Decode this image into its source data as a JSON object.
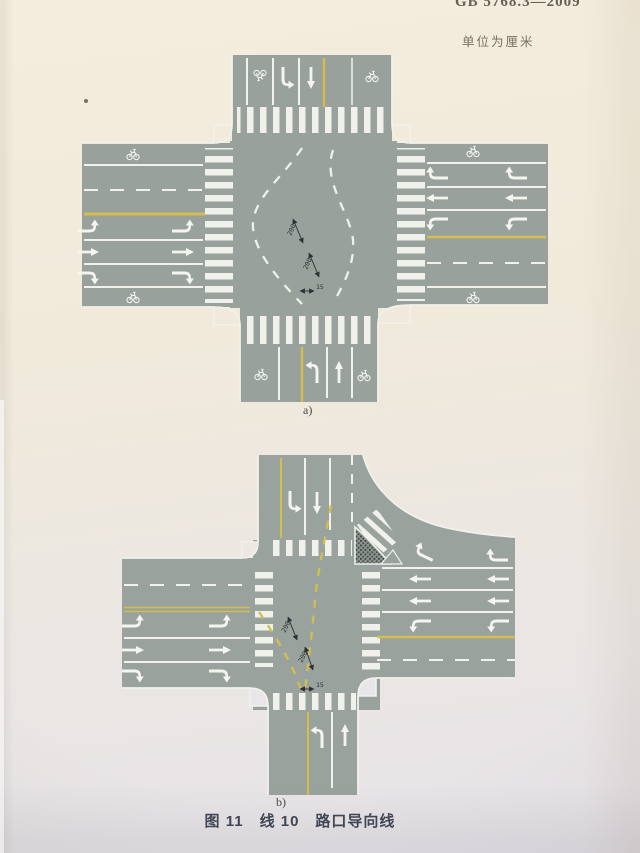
{
  "header": {
    "standard_code": "GB 5768.3—2009",
    "unit_note": "单位为厘米"
  },
  "figure": {
    "caption": "图 11　线 10　路口导向线",
    "label_a": "a)",
    "label_b": "b)"
  },
  "dimensions": {
    "dash_length": "200",
    "gap_length": "200",
    "line_width": "15"
  },
  "colors": {
    "road": "#98a19b",
    "lane-line": "#f1f2ec",
    "yellow-line": "#d3be4f",
    "paper-top": "#f4ecdd",
    "paper-bottom": "#e7e4ea",
    "dim-ink": "#2e2f35",
    "caption-ink": "#3f4553",
    "header-ink": "#56514a"
  }
}
